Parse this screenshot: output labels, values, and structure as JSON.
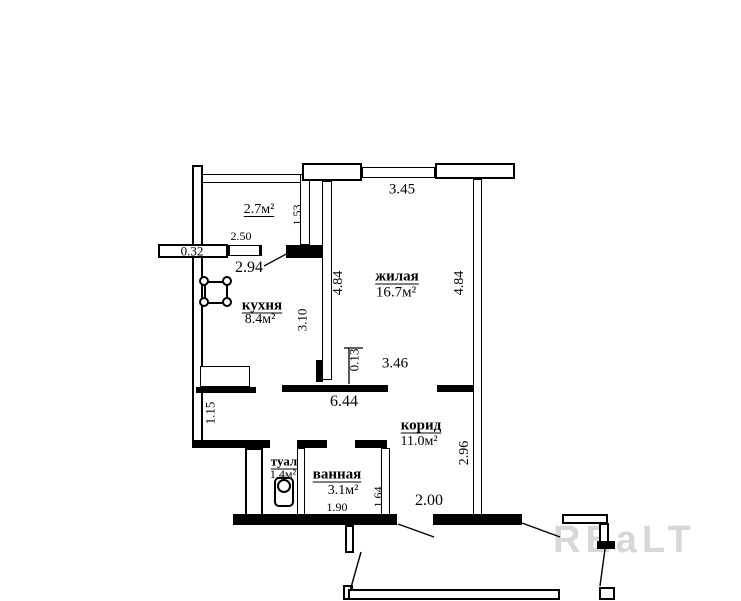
{
  "watermark_text": "REaLT",
  "colors": {
    "wall": "#000000",
    "background": "#ffffff",
    "watermark": "#d7d7d7"
  },
  "rooms": {
    "balcony": {
      "area": "2.7м²"
    },
    "kitchen": {
      "name": "кухня",
      "area": "8.4м²"
    },
    "living": {
      "name": "жилая",
      "area": "16.7м²"
    },
    "corridor": {
      "name": "корид",
      "area": "11.0м²"
    },
    "bathroom": {
      "name": "ванная",
      "area": "3.1м²"
    },
    "toilet": {
      "name": "туал",
      "area": "1.4м²"
    }
  },
  "dimensions": {
    "balcony_depth": "1.53",
    "balcony_window_width": "2.50",
    "ledge_depth": "0.32",
    "kitchen_top_width": "2.94",
    "kitchen_depth": "3.10",
    "kitchen_left_wall": "1.15",
    "hall_width": "6.44",
    "wall_offset": "0.13",
    "hall_right_width": "3.46",
    "living_top_width": "3.45",
    "living_left_depth": "4.84",
    "living_right_depth": "4.84",
    "corridor_depth": "2.96",
    "corridor_entry_width": "2.00",
    "bathroom_width": "1.90",
    "bathroom_depth": "1.64"
  }
}
